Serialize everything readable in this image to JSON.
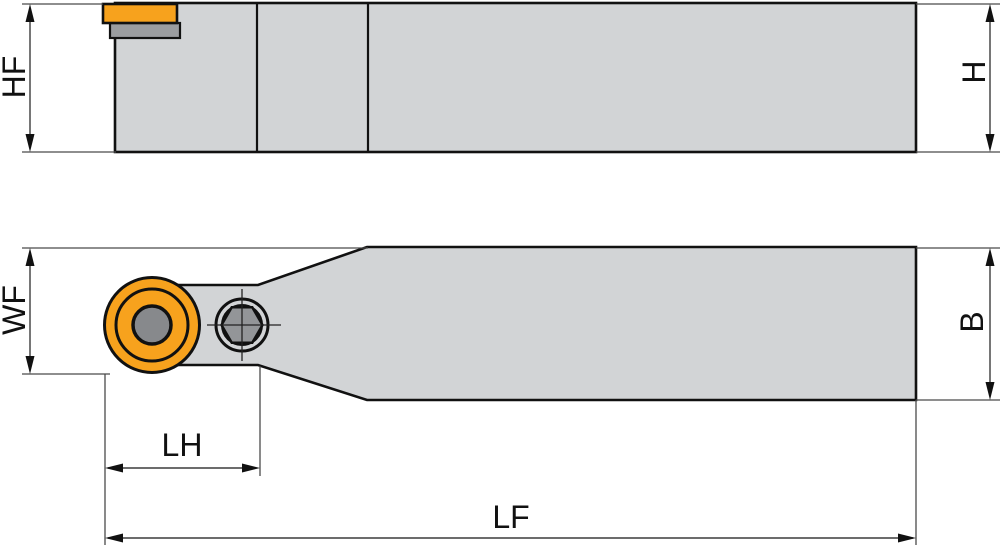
{
  "diagram": {
    "type": "technical-drawing-tool-holder",
    "views": {
      "side_view": "tool holder side elevation with insert and shim",
      "top_view": "tool holder plan view with round insert and clamp screw"
    },
    "labels": {
      "hf": "HF",
      "h": "H",
      "wf": "WF",
      "b": "B",
      "lh": "LH",
      "lf": "LF"
    },
    "colors": {
      "background": "#ffffff",
      "body_fill": "#d2d4d6",
      "outline": "#111111",
      "insert_orange": "#f7a21d",
      "shim_gray": "#9b9da0",
      "bore_gray": "#87898c",
      "hex_socket_gray": "#939598",
      "dimension_line": "#3c3c3c"
    }
  }
}
